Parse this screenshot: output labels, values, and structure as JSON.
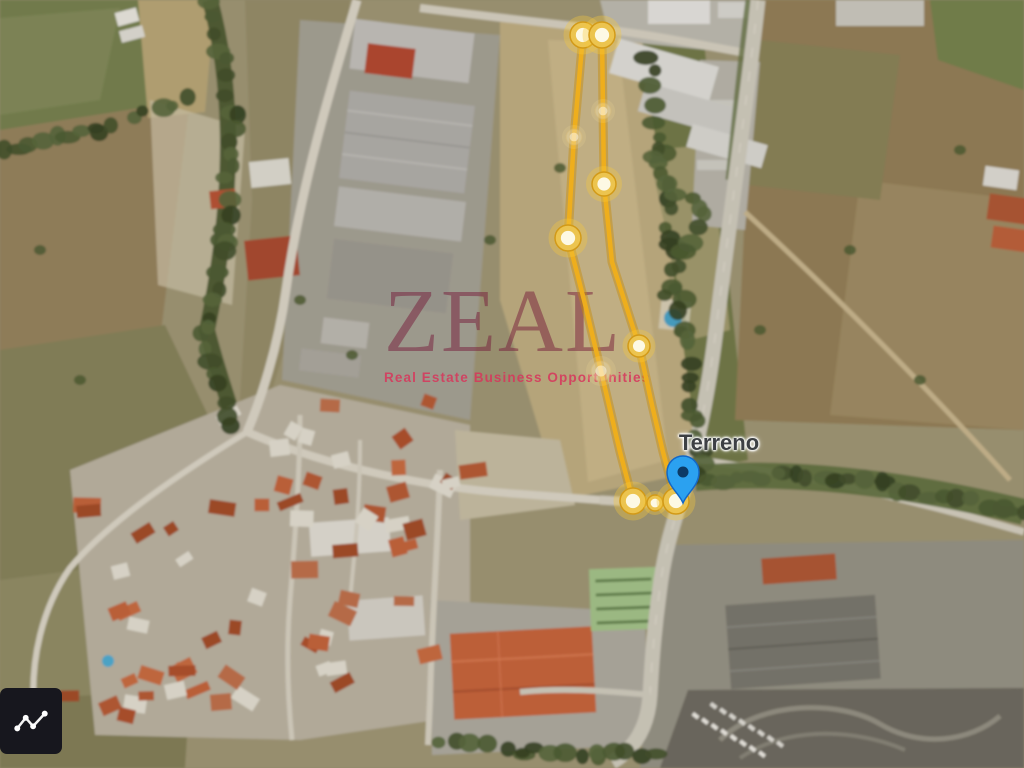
{
  "map": {
    "label": {
      "text": "Terreno",
      "x": 719,
      "y": 430
    },
    "pin": {
      "x": 683,
      "y": 503,
      "body_color": "#2ba1f0",
      "border_color": "#1467c6",
      "dot_color": "#0c3a66"
    },
    "boundary": {
      "stroke_color": "#eeae1d",
      "glow_color": "rgba(198,140,8,0.45)",
      "path_points": [
        [
          583,
          35
        ],
        [
          602,
          35
        ],
        [
          603,
          111
        ],
        [
          604,
          184
        ],
        [
          612,
          262
        ],
        [
          639,
          346
        ],
        [
          652,
          405
        ],
        [
          663,
          452
        ],
        [
          676,
          500
        ],
        [
          655,
          502
        ],
        [
          633,
          501
        ],
        [
          620,
          452
        ],
        [
          601,
          371
        ],
        [
          584,
          300
        ],
        [
          568,
          238
        ],
        [
          574,
          137
        ]
      ],
      "vertices": [
        {
          "x": 583,
          "y": 35,
          "r": 13,
          "faint": false
        },
        {
          "x": 602,
          "y": 35,
          "r": 13,
          "faint": false
        },
        {
          "x": 603,
          "y": 111,
          "r": 8,
          "faint": true
        },
        {
          "x": 574,
          "y": 137,
          "r": 8,
          "faint": true
        },
        {
          "x": 604,
          "y": 184,
          "r": 12,
          "faint": false
        },
        {
          "x": 568,
          "y": 238,
          "r": 13,
          "faint": false
        },
        {
          "x": 639,
          "y": 346,
          "r": 11,
          "faint": false
        },
        {
          "x": 601,
          "y": 371,
          "r": 10,
          "faint": true
        },
        {
          "x": 633,
          "y": 501,
          "r": 13,
          "faint": false
        },
        {
          "x": 655,
          "y": 503,
          "r": 8,
          "faint": false
        },
        {
          "x": 676,
          "y": 501,
          "r": 13,
          "faint": false
        }
      ]
    }
  },
  "watermark": {
    "title": "ZEAL",
    "subtitle": "Real Estate Business Opportunities",
    "title_color": "rgba(118,28,58,0.5)",
    "subtitle_color": "rgba(214,56,92,0.88)"
  },
  "icons": {
    "corner_tool": "polyline-draw-icon",
    "marker": "map-pin-icon"
  }
}
